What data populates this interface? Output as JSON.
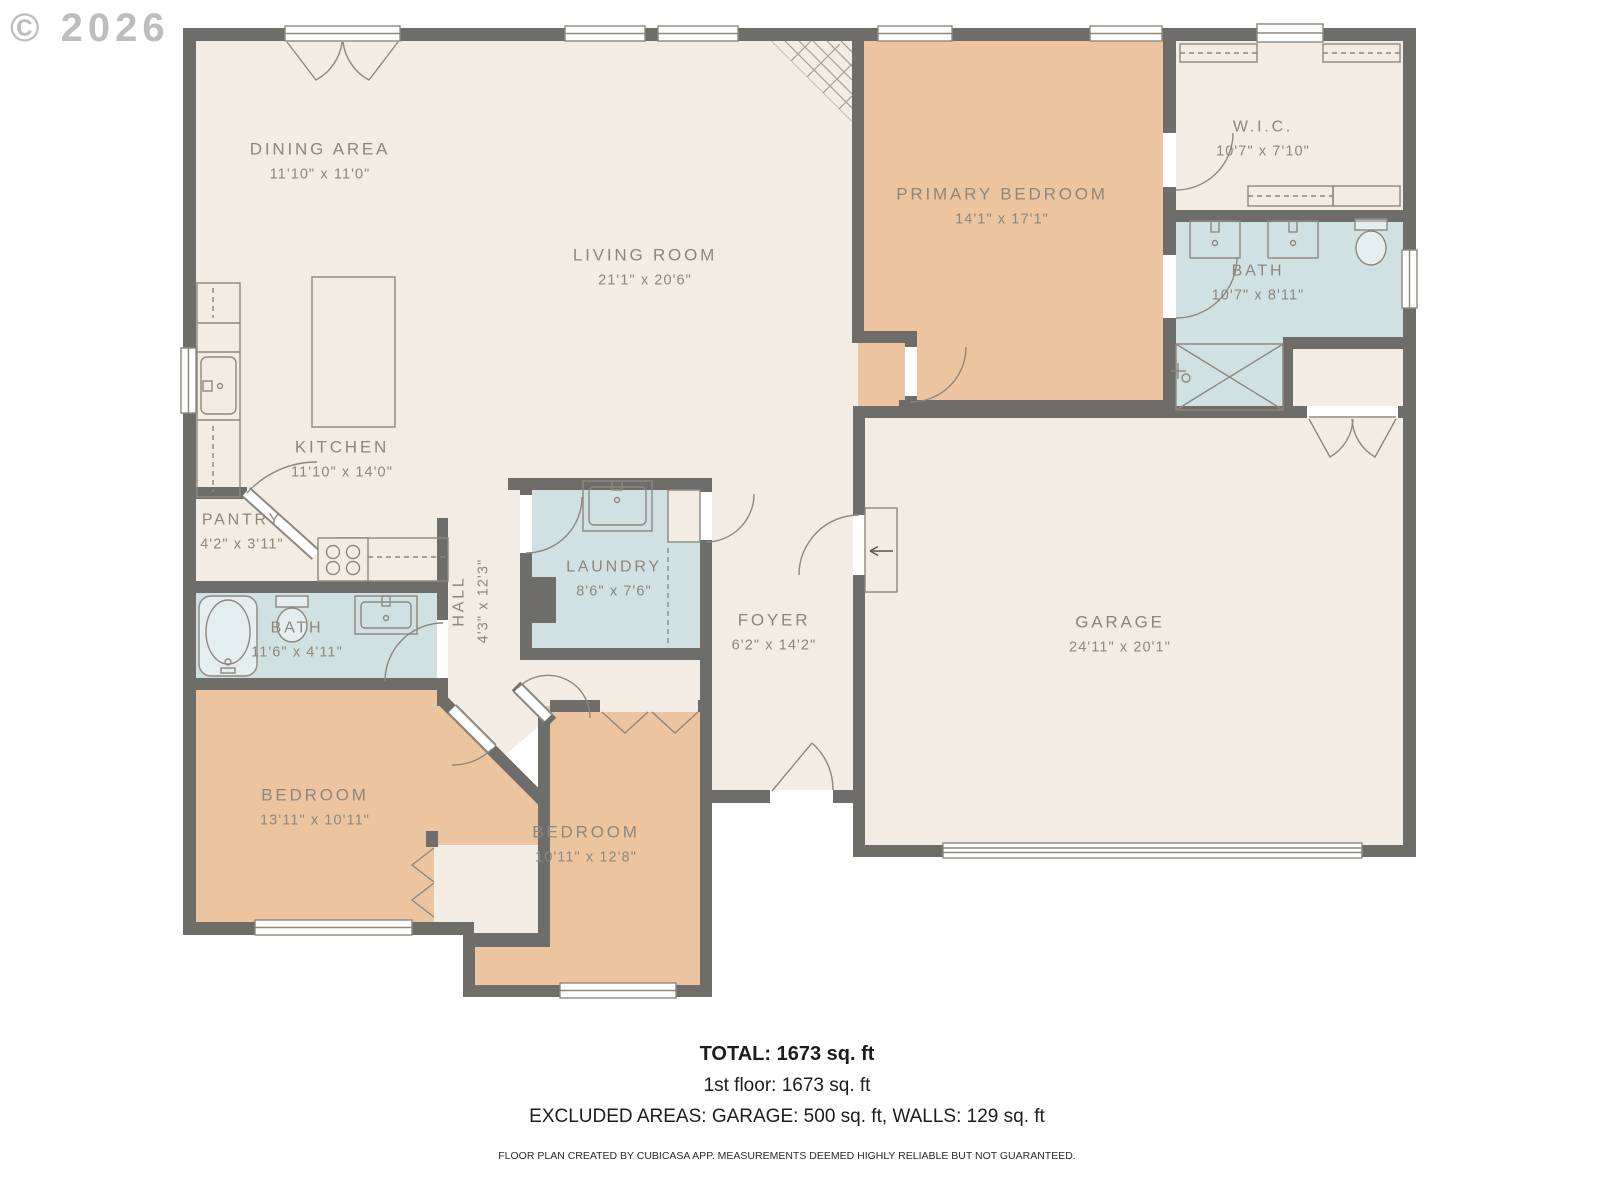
{
  "watermark": "© 2026",
  "rooms": [
    {
      "id": "dining-area",
      "name": "DINING AREA",
      "dims": "11'10\" x 11'0\""
    },
    {
      "id": "living-room",
      "name": "LIVING ROOM",
      "dims": "21'1\" x 20'6\""
    },
    {
      "id": "primary-bedroom",
      "name": "PRIMARY BEDROOM",
      "dims": "14'1\" x 17'1\""
    },
    {
      "id": "wic",
      "name": "W.I.C.",
      "dims": "10'7\" x 7'10\""
    },
    {
      "id": "bath-primary",
      "name": "BATH",
      "dims": "10'7\" x 8'11\""
    },
    {
      "id": "kitchen",
      "name": "KITCHEN",
      "dims": "11'10\" x 14'0\""
    },
    {
      "id": "pantry",
      "name": "PANTRY",
      "dims": "4'2\" x 3'11\""
    },
    {
      "id": "hall",
      "name": "HALL",
      "dims": "4'3\" x 12'3\""
    },
    {
      "id": "laundry",
      "name": "LAUNDRY",
      "dims": "8'6\" x 7'6\""
    },
    {
      "id": "bath-hall",
      "name": "BATH",
      "dims": "11'6\" x 4'11\""
    },
    {
      "id": "foyer",
      "name": "FOYER",
      "dims": "6'2\" x 14'2\""
    },
    {
      "id": "garage",
      "name": "GARAGE",
      "dims": "24'11\" x 20'1\""
    },
    {
      "id": "bedroom-1",
      "name": "BEDROOM",
      "dims": "13'11\" x 10'11\""
    },
    {
      "id": "bedroom-2",
      "name": "BEDROOM",
      "dims": "10'11\" x 12'8\""
    }
  ],
  "footer": {
    "total": "TOTAL: 1673 sq. ft",
    "first_floor": "1st floor: 1673 sq. ft",
    "excluded": "EXCLUDED AREAS: GARAGE: 500 sq. ft, WALLS: 129 sq. ft",
    "disclaimer": "FLOOR PLAN CREATED BY CUBICASA APP. MEASUREMENTS DEEMED HIGHLY RELIABLE BUT NOT GUARANTEED."
  },
  "colors": {
    "wall": "#6f6d69",
    "room_cream": "#f3ece4",
    "room_tan": "#ecc5a0",
    "room_blue": "#cfe1e2",
    "fixture_line": "#8e877e",
    "label_text": "#8d867c",
    "watermark_text": "#bdbdbd"
  }
}
